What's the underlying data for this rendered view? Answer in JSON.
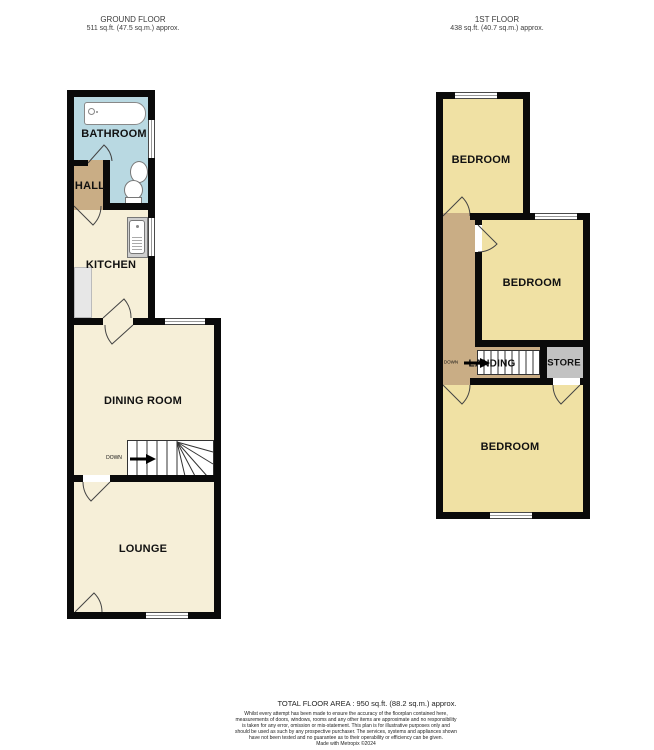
{
  "ground_floor": {
    "title": "GROUND FLOOR",
    "area": "511 sq.ft. (47.5 sq.m.) approx.",
    "rooms": {
      "bathroom": "BATHROOM",
      "hall": "HALL",
      "kitchen": "KITCHEN",
      "dining_room": "DINING ROOM",
      "lounge": "LOUNGE"
    },
    "stairs": {
      "label": "DOWN"
    }
  },
  "first_floor": {
    "title": "1ST FLOOR",
    "area": "438 sq.ft. (40.7 sq.m.) approx.",
    "rooms": {
      "bedroom_front": "BEDROOM",
      "bedroom_middle": "BEDROOM",
      "bedroom_back": "BEDROOM",
      "landing": "LANDING",
      "store": "STORE"
    },
    "stairs": {
      "label": "DOWN"
    }
  },
  "footer": {
    "total_area": "TOTAL FLOOR AREA : 950 sq.ft. (88.2 sq.m.) approx.",
    "disclaimer": "Whilst every attempt has been made to ensure the accuracy of the floorplan contained here, measurements of doors, windows, rooms and any other items are approximate and no responsibility is taken for any error, omission or mis-statement. This plan is for illustrative purposes only and should be used as such by any prospective purchaser. The services, systems and appliances shown have not been tested and no guarantee as to their operability or efficiency can be given.",
    "credit": "Made with Metropix ©2024"
  },
  "colors": {
    "bathroom_fill": "#b9d9e2",
    "hall_landing_fill": "#c9ad85",
    "ground_room_fill": "#f6efd8",
    "bedroom_fill": "#f0e1a4",
    "store_fill": "#c2c2c2",
    "counter_fill": "#e7e7e7",
    "wall": "#0a0a0a"
  }
}
